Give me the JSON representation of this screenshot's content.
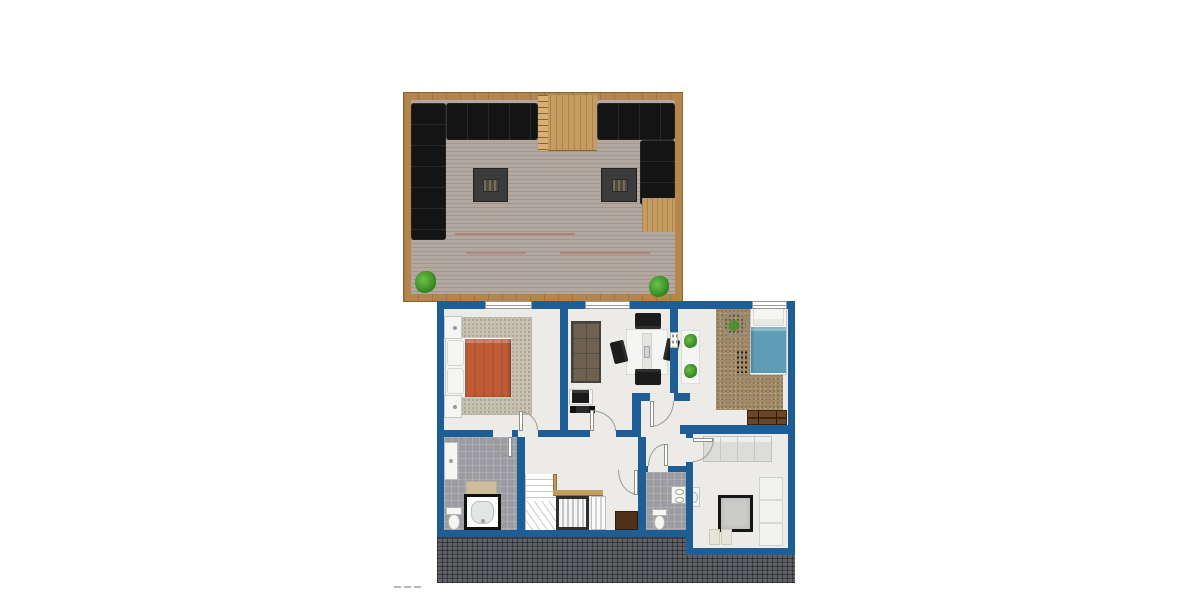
{
  "meta": {
    "kind": "architectural-floor-plan-rendering",
    "background": "#ffffff"
  },
  "palette": {
    "wall": "#1E5E96",
    "floorLight": "#ECEBE7",
    "tileGray": "#9C9CA2",
    "rugBeige": "#C6BFAE",
    "carpetBrown": "#A18A67",
    "blanketOrange": "#BF5B36",
    "blanketBlue": "#5E9DB6",
    "deckFrame": "#B5854E",
    "deckWood": "#C59C60",
    "deckBoard": "#B3A89F",
    "deckBoardLine": "#A2978E",
    "sofaBlack": "#141414",
    "tableDark": "#3B3B3B",
    "plantGreen": "#3E9428",
    "dresserBrown": "#6A4526",
    "benchBrown": "#4F3018",
    "sofaTan": "#6E6150",
    "roofDark": "#5D5F64",
    "furnWhite": "#F5F5F3"
  },
  "deck": {
    "name": "roof-terrace",
    "items": [
      "sectional-sofa-left",
      "sectional-sofa-right",
      "fire-table-left",
      "fire-table-right",
      "wood-walkway",
      "ladder-strip",
      "wood-patch-right",
      "planter-left",
      "planter-right"
    ]
  },
  "floorplan": {
    "rooms": [
      {
        "id": "bedroom-left",
        "furniture": [
          "double-bed-orange",
          "pillows",
          "nightstand-top",
          "nightstand-bottom",
          "area-rug",
          "window",
          "door"
        ]
      },
      {
        "id": "living-dining",
        "furniture": [
          "tan-sofa",
          "dining-table",
          "four-black-chairs",
          "desk-with-printer",
          "window",
          "door"
        ]
      },
      {
        "id": "bedroom-right",
        "furniture": [
          "single-bed-blue",
          "brown-carpet",
          "round-basket",
          "dot-rug",
          "dresser",
          "plant-shelf",
          "two-plants",
          "window",
          "door"
        ]
      },
      {
        "id": "bathroom",
        "furniture": [
          "bathtub",
          "toilet",
          "vanity",
          "bath-mat",
          "door"
        ]
      },
      {
        "id": "hallway-stairs",
        "furniture": [
          "winder-staircase",
          "wood-handrail-strip",
          "wardrobe-louvered",
          "closet-louvered",
          "bench-brown",
          "doors"
        ]
      },
      {
        "id": "wc",
        "furniture": [
          "toilet",
          "double-sink-counter",
          "door"
        ]
      },
      {
        "id": "lounge-bottom-right",
        "furniture": [
          "daybed",
          "black-frame-square-table",
          "white-sofa",
          "side-table",
          "seat-cushions",
          "door"
        ]
      }
    ]
  },
  "roof": {
    "texture": "dark-tile-hatch-band"
  }
}
